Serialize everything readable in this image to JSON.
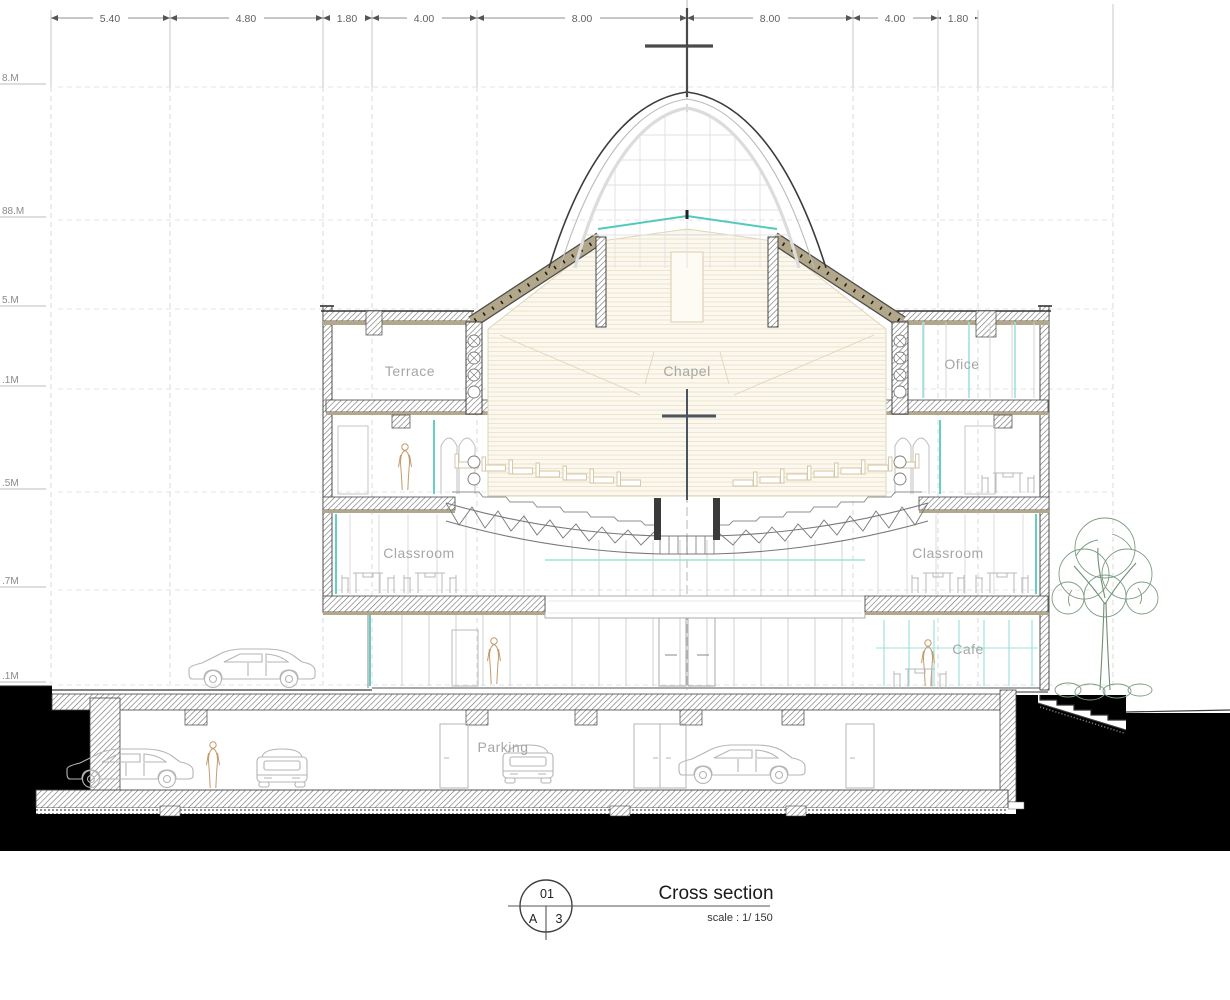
{
  "drawing": {
    "dimensions_top": [
      "5.40",
      "4.80",
      "1.80",
      "4.00",
      "8.00",
      "8.00",
      "4.00",
      "1.80"
    ],
    "elevation_labels": [
      "8.M",
      "88.M",
      "5.M",
      ".1M",
      ".5M",
      ".7M",
      ".1M"
    ],
    "rooms": {
      "terrace": "Terrace",
      "chapel": "Chapel",
      "office": "Ofice",
      "classroom_left": "Classroom",
      "classroom_right": "Classroom",
      "cafe": "Cafe",
      "parking": "Parking"
    },
    "title_block": {
      "sheet_number": "01",
      "grid_row": "A",
      "grid_col": "3",
      "title": "Cross section",
      "scale": "scale : 1/ 150"
    },
    "colors": {
      "teal": "#52c9bc",
      "teal_soft": "#9fe2da",
      "tan": "#b3a789",
      "cream": "#fbf8ef",
      "tree_green": "#7c9c80",
      "ink": "#3c3c3c",
      "ground_black": "#000000"
    }
  }
}
